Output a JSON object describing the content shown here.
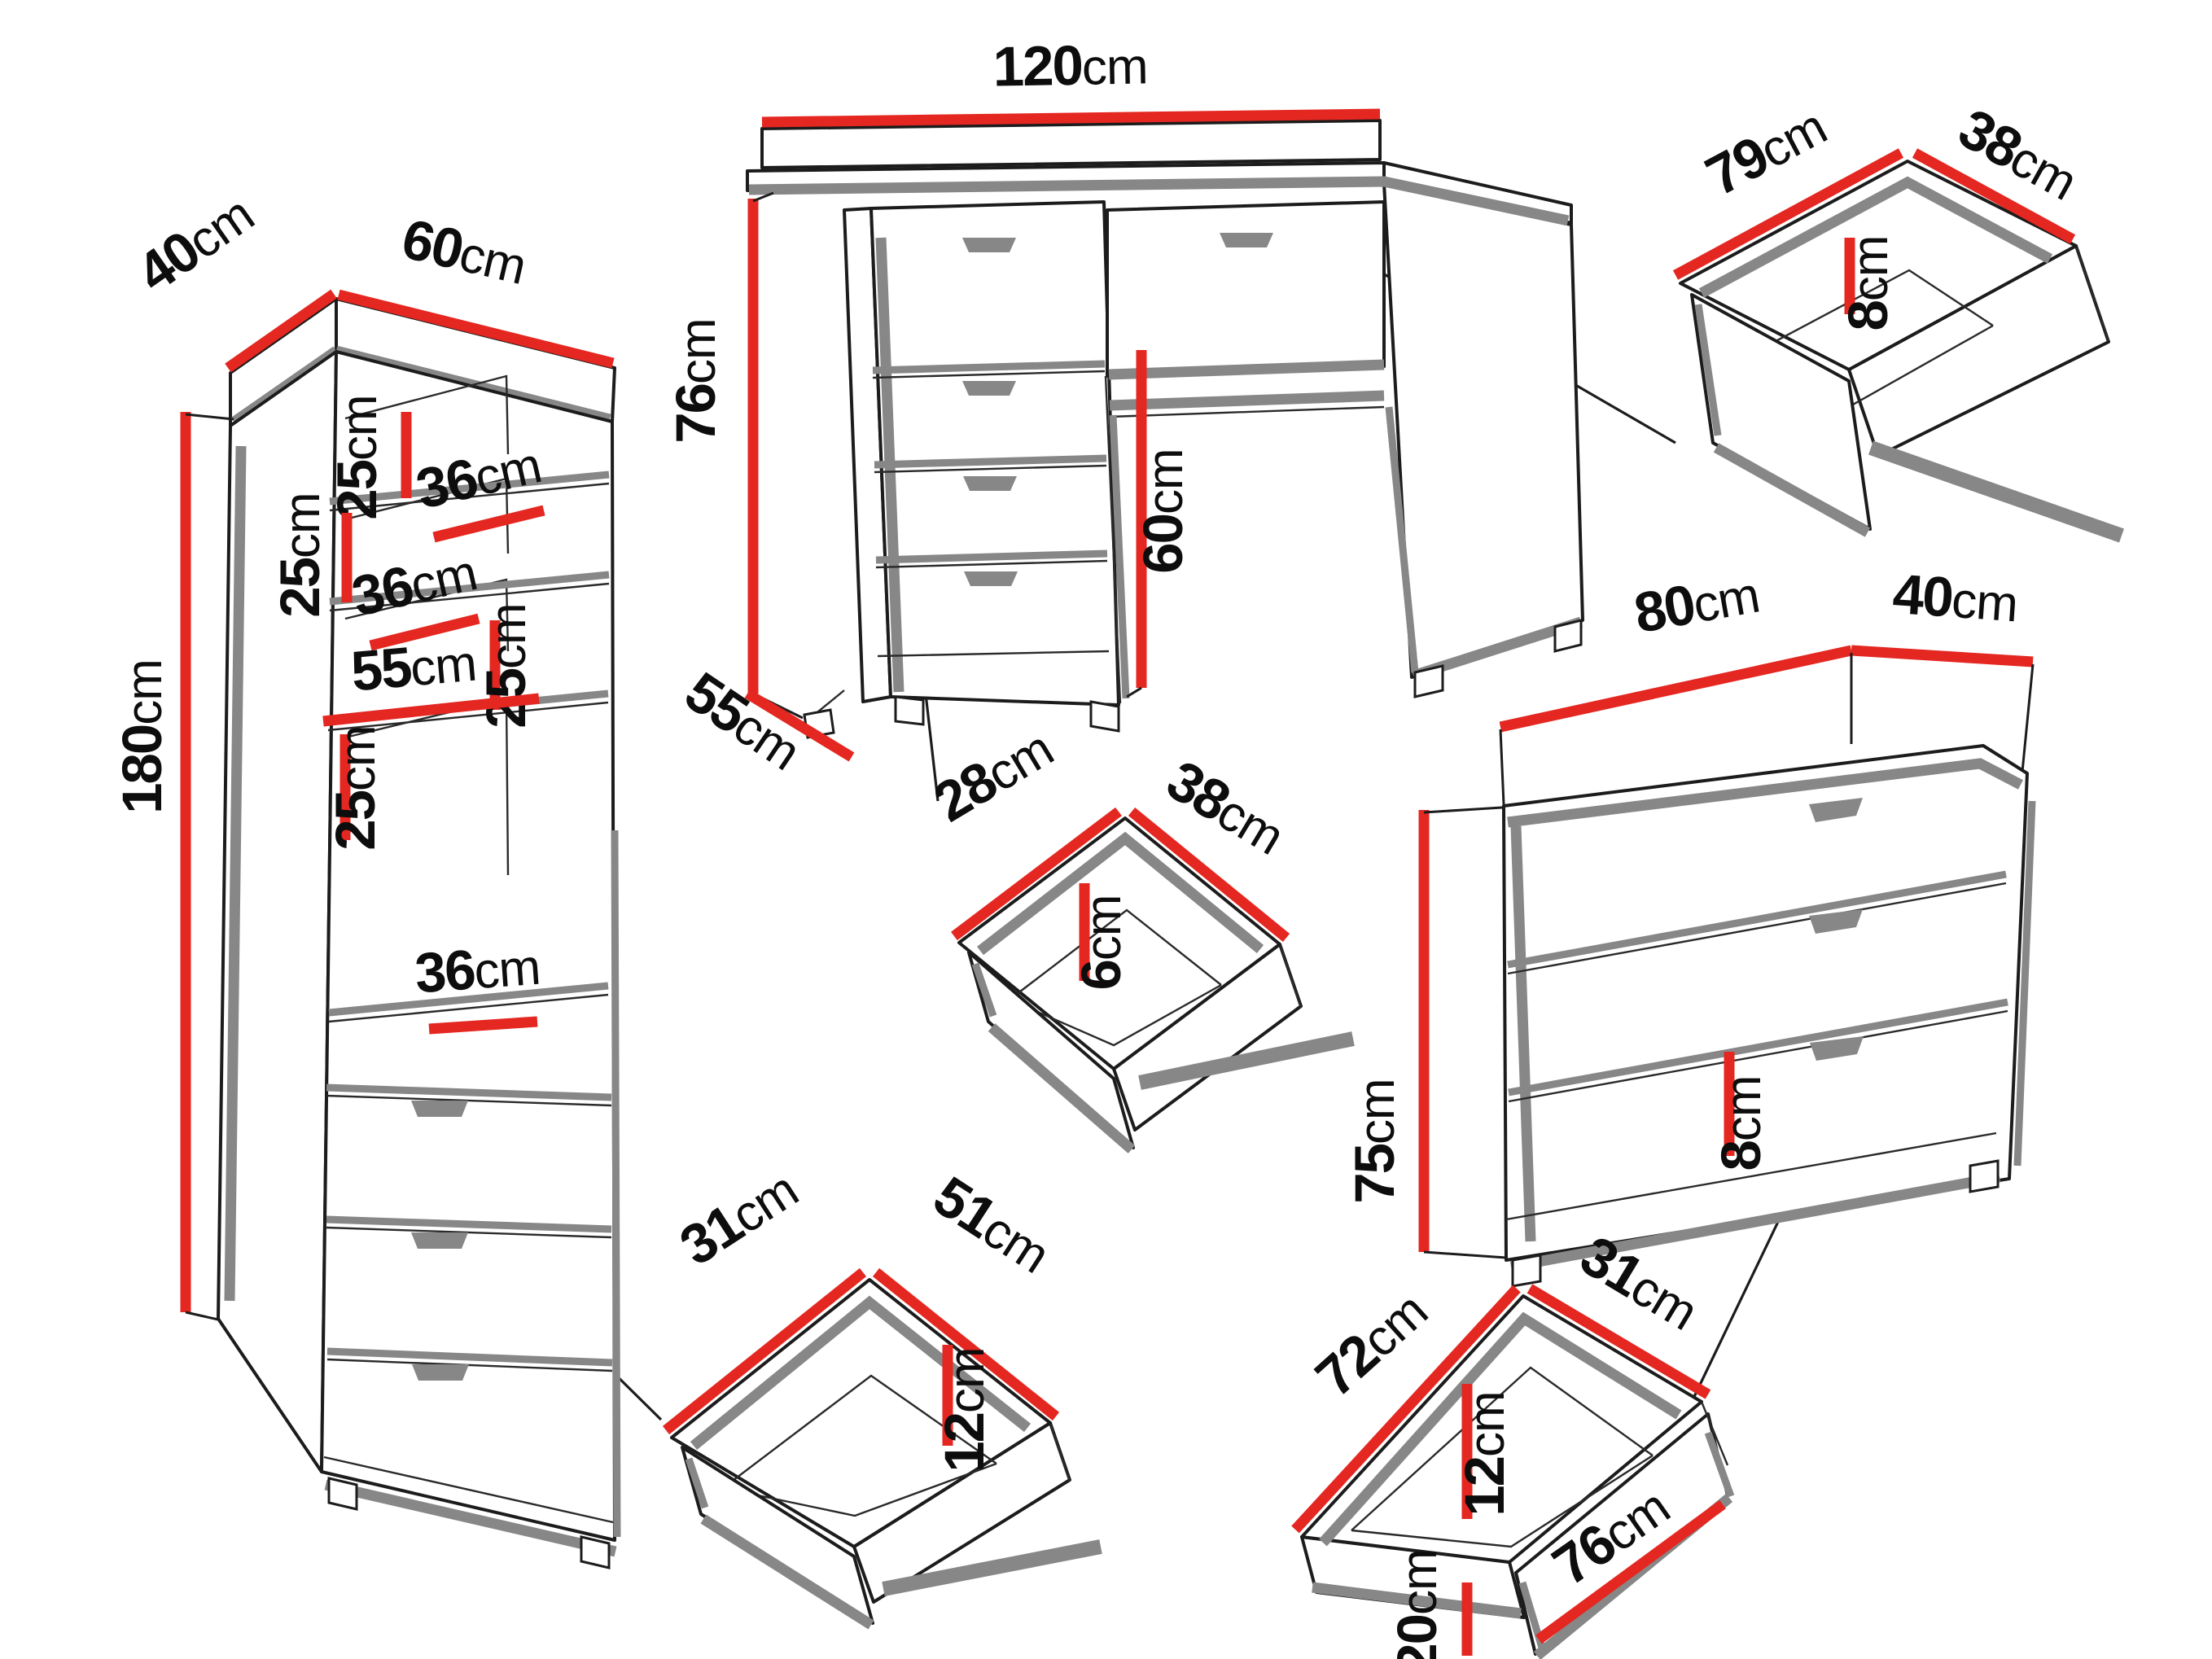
{
  "unit": "cm",
  "colors": {
    "accent_red": "#e42721",
    "shadow_gray": "#878787",
    "line_black": "#1c1c1c",
    "background": "#ffffff"
  },
  "wardrobe": {
    "depth": "40",
    "width": "60",
    "height": "180",
    "compartment_height": "25",
    "shelf_depth": "36",
    "shelf_width": "55"
  },
  "desk": {
    "width": "120",
    "height": "76",
    "depth": "55",
    "knee_clearance": "60"
  },
  "desk_top_drawer": {
    "width": "79",
    "depth": "38",
    "height": "8"
  },
  "desk_side_drawer": {
    "depth": "28",
    "width": "38",
    "height": "6"
  },
  "wardrobe_drawer": {
    "depth": "31",
    "width": "51",
    "height": "12"
  },
  "chest": {
    "width": "80",
    "depth": "40",
    "height": "75",
    "plinth_height": "8"
  },
  "chest_drawer": {
    "width": "72",
    "depth": "31",
    "inner_height": "12",
    "front_height": "20",
    "front_width": "76"
  }
}
